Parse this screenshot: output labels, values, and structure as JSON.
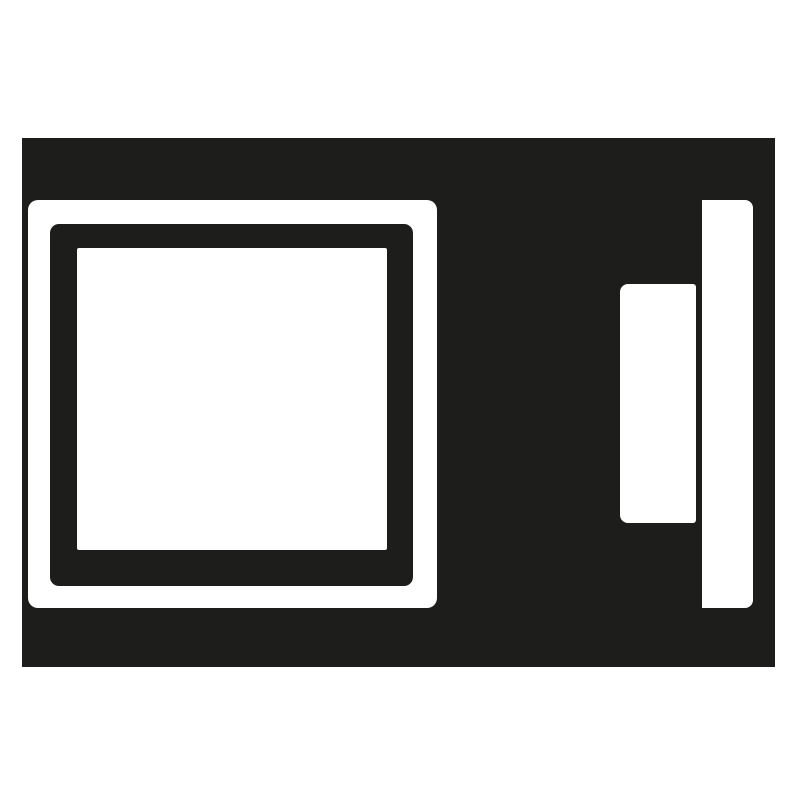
{
  "meta": {
    "description": "Black-and-white flat pictogram of an appliance: body with square door window on the left, control panel and edge bar on the right",
    "canvas": {
      "width_px": 800,
      "height_px": 800
    }
  },
  "colors": {
    "ink": "#1d1d1b",
    "background": "#ffffff",
    "paper": "#ffffff"
  },
  "icon": {
    "name": "appliance-pictogram",
    "parts": {
      "body": "appliance-body",
      "door_frame_outer": "white rounded frame",
      "door_frame_inner": "black rounded frame",
      "door_window": "white window pane",
      "control_panel": "small white panel",
      "handle_bar": "tall white bar at right edge"
    }
  }
}
